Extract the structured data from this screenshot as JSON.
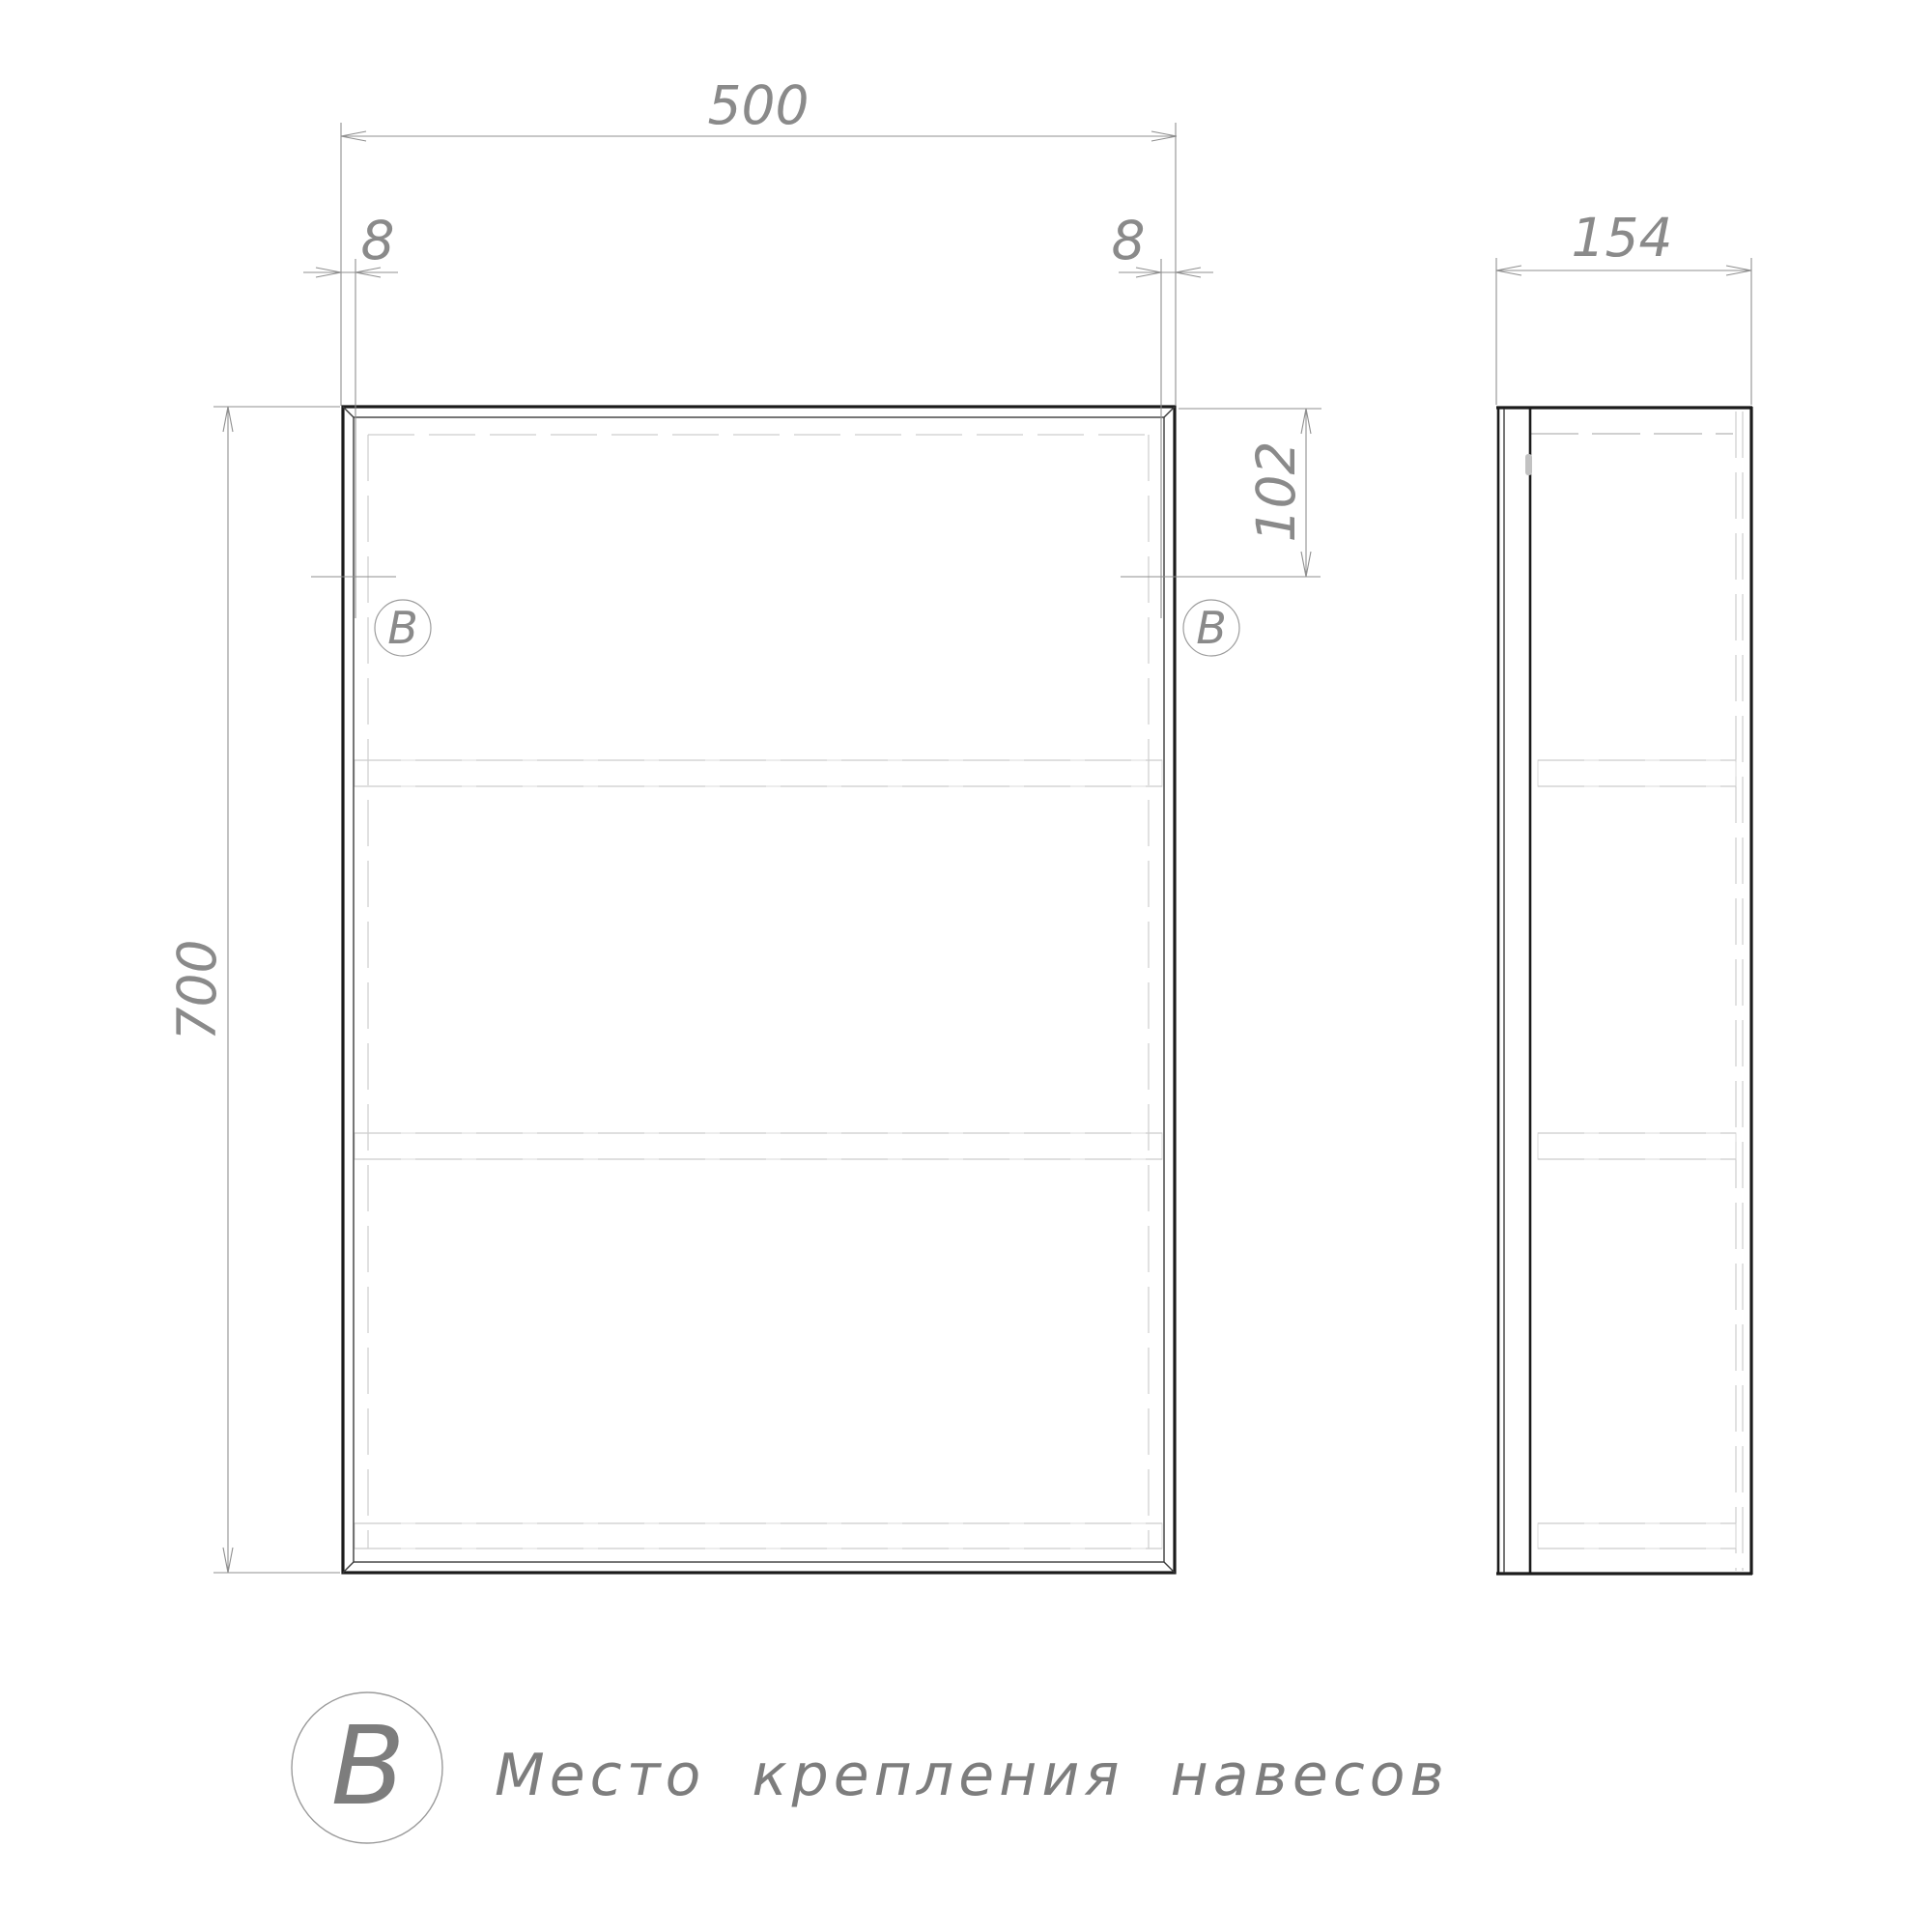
{
  "dimensions": {
    "front_width": "500",
    "front_height": "700",
    "hinge_offset_left": "8",
    "hinge_offset_right": "8",
    "mount_vertical_offset": "102",
    "side_depth": "154"
  },
  "markers": {
    "left_label": "В",
    "right_label": "В"
  },
  "legend": {
    "symbol": "В",
    "description": "Место крепления навесов"
  },
  "colors": {
    "background": "#ffffff",
    "outline": "#1b1b1b",
    "dimension_lines": "#8f8f8f",
    "dimension_text": "#8a8a8a",
    "hidden_lines": "#cdcdcd",
    "shelf_lines": "#dedede",
    "legend_text": "#7d7d7d"
  }
}
